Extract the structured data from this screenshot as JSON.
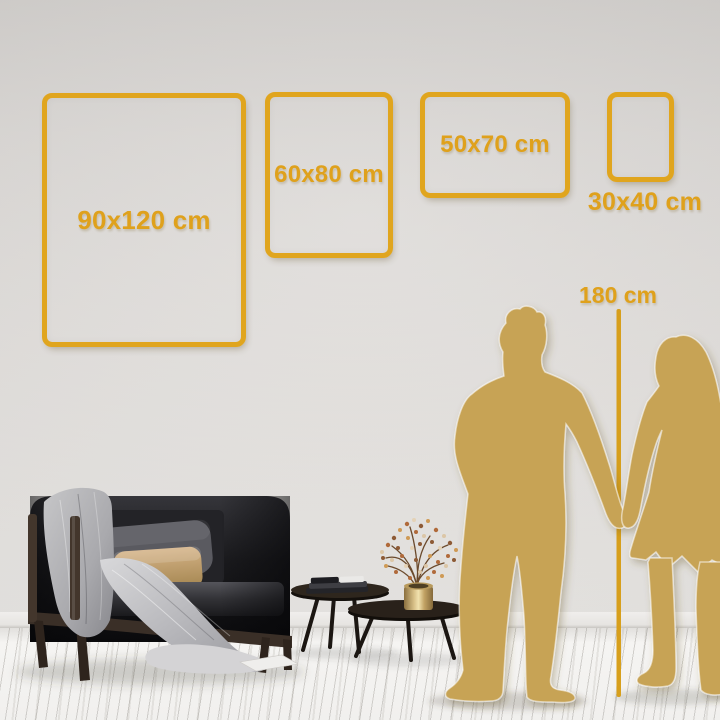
{
  "page": {
    "title": "Wall art size comparison guide"
  },
  "palette": {
    "gold": "#E0A51E",
    "gold_text": "#DFA11C",
    "silhouette_gold": "#C7A355",
    "wall_top": "#D0CDCA",
    "wall_bottom": "#EAE8E5",
    "floor": "#F5F4F2"
  },
  "frames": [
    {
      "id": "90x120",
      "label": "90x120 cm",
      "orientation": "portrait",
      "label_position": "inside"
    },
    {
      "id": "60x80",
      "label": "60x80 cm",
      "orientation": "portrait",
      "label_position": "inside"
    },
    {
      "id": "50x70",
      "label": "50x70 cm",
      "orientation": "landscape",
      "label_position": "inside"
    },
    {
      "id": "30x40",
      "label": "30x40 cm",
      "orientation": "portrait",
      "label_position": "below"
    }
  ],
  "height_marker": {
    "label": "180 cm"
  },
  "scene": {
    "items": [
      "sofa-with-throw-blanket",
      "gray-pillow",
      "beige-pillow",
      "nesting-coffee-tables",
      "stacked-books",
      "brass-vase-with-dried-flowers",
      "man-silhouette",
      "woman-silhouette",
      "height-measure-line"
    ]
  }
}
